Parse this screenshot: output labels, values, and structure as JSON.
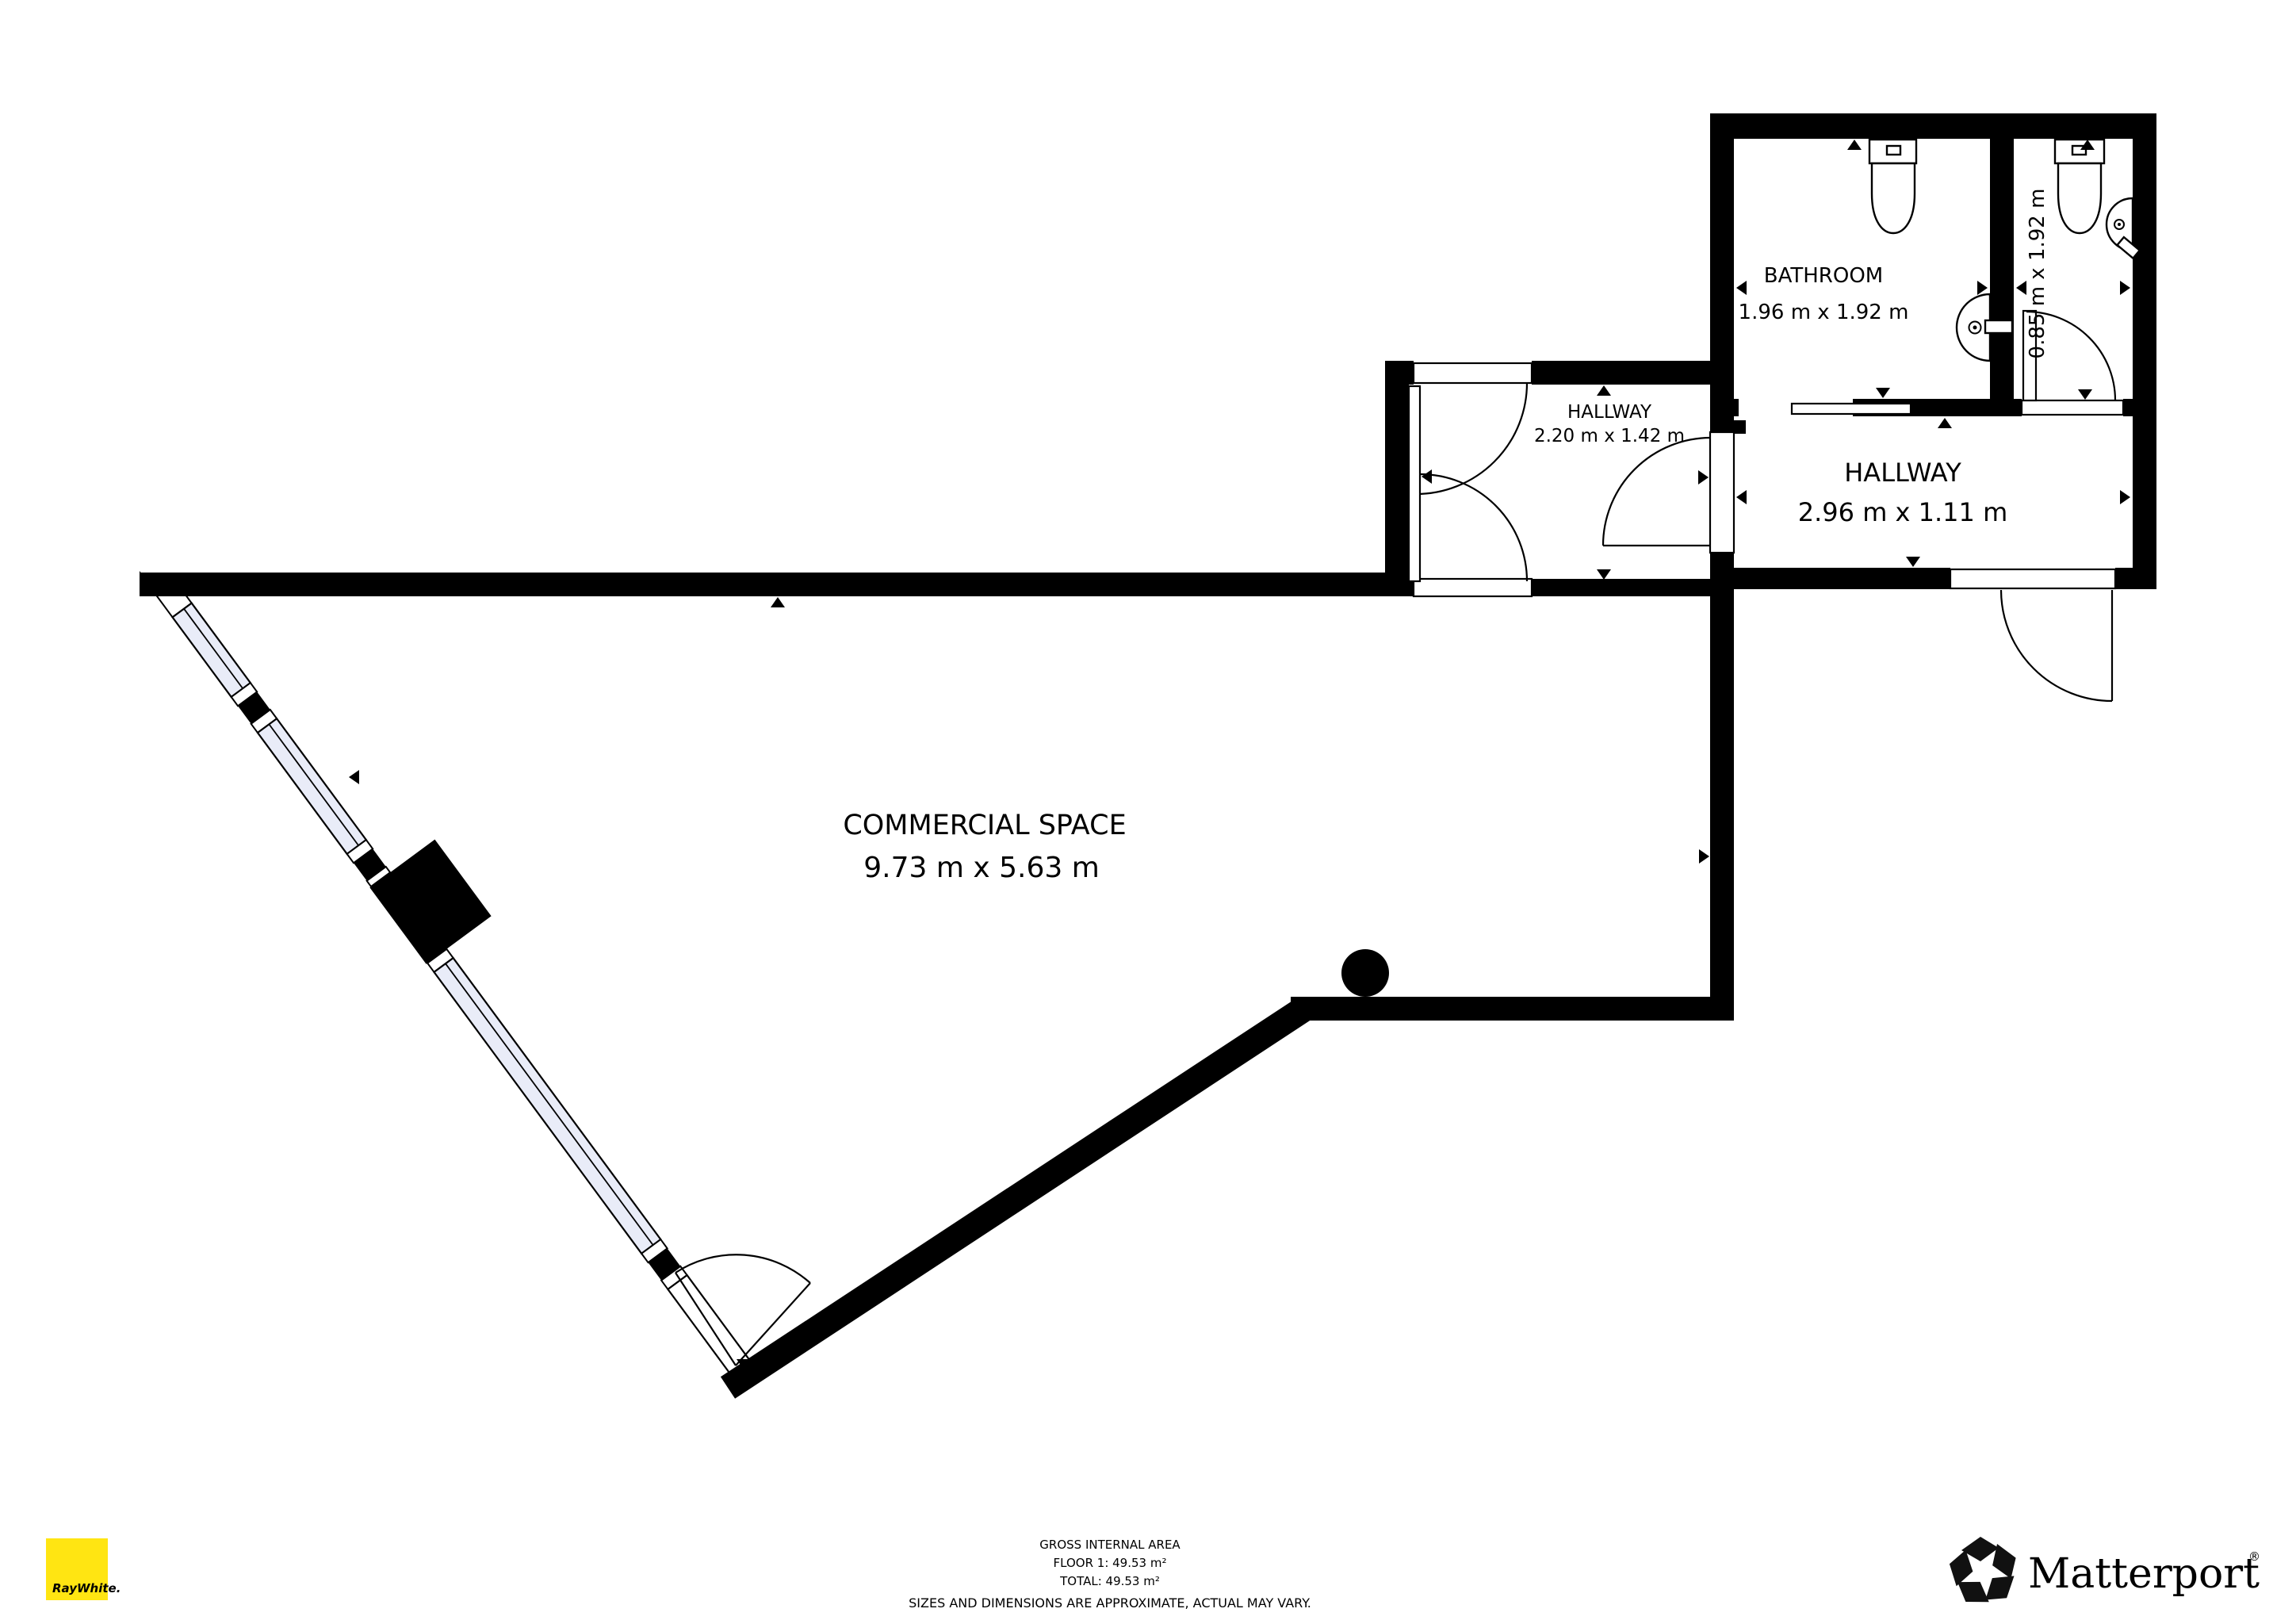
{
  "rooms": [
    {
      "id": "commercial-space",
      "name": "COMMERCIAL SPACE",
      "dims": "9.73 m x 5.63 m"
    },
    {
      "id": "bathroom",
      "name": "BATHROOM",
      "dims": "1.96 m x 1.92 m"
    },
    {
      "id": "wc",
      "name": "",
      "dims": "0.85 m x 1.92 m"
    },
    {
      "id": "hallway-small",
      "name": "HALLWAY",
      "dims": "2.20 m x 1.42 m"
    },
    {
      "id": "hallway-main",
      "name": "HALLWAY",
      "dims": "2.96 m x 1.11 m"
    }
  ],
  "footer": {
    "gross_area_title": "GROSS INTERNAL AREA",
    "floor_line": "FLOOR 1: 49.53 m²",
    "total_line": "TOTAL: 49.53 m²",
    "disclaimer": "SIZES AND DIMENSIONS ARE APPROXIMATE, ACTUAL MAY VARY."
  },
  "branding": {
    "agency": {
      "label": "RayWhite.",
      "square_color": "#ffe512",
      "text_color": "#414042"
    },
    "provider": {
      "label": "Matterport",
      "registered_mark": "®",
      "color": "#111111"
    }
  },
  "colors": {
    "wall": "#000000",
    "window_fill": "#e9ecf8",
    "background": "#ffffff",
    "disclaimer_text": "#b3b3b3"
  }
}
